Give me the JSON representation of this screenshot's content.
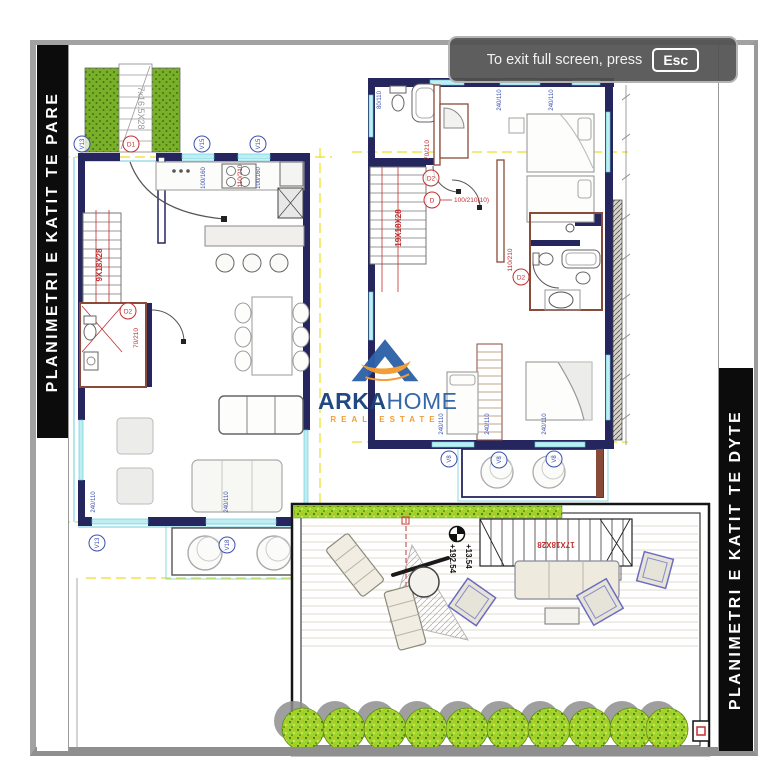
{
  "viewer": {
    "notice_message": "To exit full screen, press",
    "notice_key": "Esc"
  },
  "titles": {
    "left_bar": "PLANIMETRI E KATIT TE PARE",
    "right_bar": "PLANIMETRI E KATIT TE DYTE"
  },
  "watermark": {
    "brand_a": "ARKA",
    "brand_b": "HOME",
    "tagline": "REAL ESTATE"
  },
  "first_floor": {
    "exterior_stair": "7x16.5X28",
    "interior_stair": "9X18X28",
    "door_main_tag": "D1",
    "door_main_dim": "110/210",
    "door_bath_tag": "D2",
    "door_bath_dim": "70/210",
    "win_top_corner_tag": "V13",
    "win_top1_tag": "V15",
    "win_top1_dim": "100/160",
    "win_top2_tag": "V15",
    "win_top2_dim": "100/160",
    "win_bottom1_tag": "V13",
    "win_bottom1_dim": "240/110",
    "win_bottom2_tag": "V18",
    "win_bottom2_dim": "240/110"
  },
  "second_floor": {
    "interior_stair": "19X18X28",
    "door_bath_tag": "D2",
    "door_bath_dim": "70/210",
    "door_bed_tag": "D",
    "door_bed_dim": "100/210(10)",
    "door_bath2_tag": "D2",
    "door_bath2_dim": "110/210",
    "win_dim_left": "80/110",
    "win_dim_mid": "240/110",
    "win_dim_right": "240/110",
    "win_b1_tag": "V8",
    "win_b1_dim": "240/110",
    "win_b2_tag": "V8",
    "win_b2_dim": "240/110",
    "win_b3_tag": "V8",
    "win_b3_dim": "240/110"
  },
  "terrace": {
    "stair": "17X18X28",
    "level_a": "+13.54",
    "level_b": "+192.54"
  },
  "colors": {
    "wall_navy": "#26265e",
    "wall_tan": "#8a4a3a",
    "window_cyan": "#5fc8d8",
    "axis_yellow": "#e8dc00",
    "annotation_red": "#c03030",
    "annotation_blue": "#3a4fb0",
    "planter_green": "#79b02a",
    "tree_green": "#9fd42c",
    "brand_blue": "#2d62a8",
    "brand_orange": "#f29a2e"
  }
}
